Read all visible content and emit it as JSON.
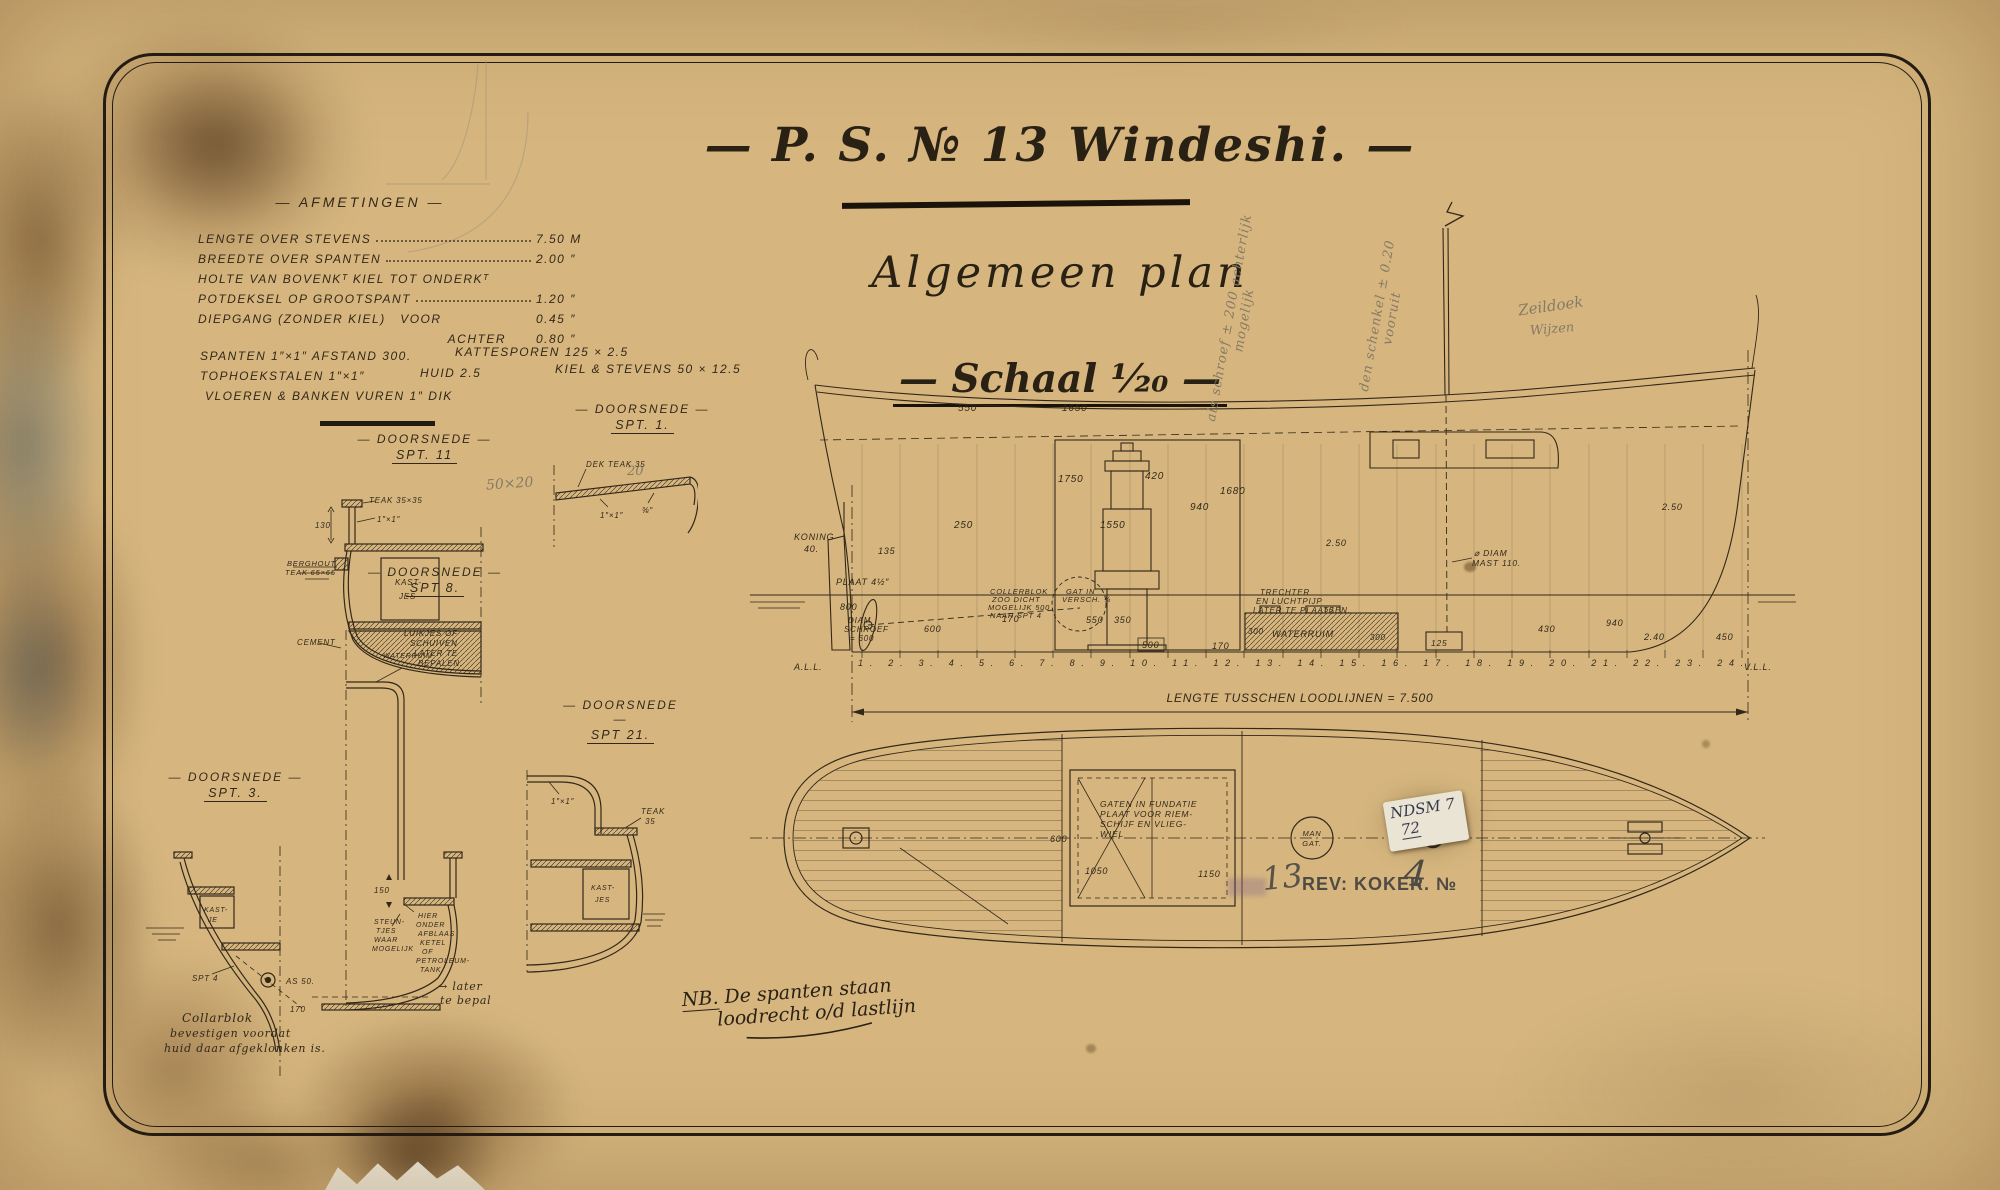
{
  "colors": {
    "paper": "#d6b67e",
    "ink": "#32281a",
    "pencil": "#857a67",
    "stamp": "#4e4a44"
  },
  "title": {
    "main": "— P. S. № 13 Windeshi. —",
    "subtitle": "Algemeen plan",
    "scale": "— Schaal ¹⁄₂₀ —"
  },
  "afmetingen": {
    "heading": "— AFMETINGEN —",
    "rows": [
      {
        "label": "LENGTE OVER STEVENS",
        "value": "7.50 M"
      },
      {
        "label": "BREEDTE OVER SPANTEN",
        "value": "2.00 ″"
      },
      {
        "label": "HOLTE VAN BOVENKᵀ KIEL TOT ONDERKᵀ",
        "value": ""
      },
      {
        "label": "POTDEKSEL OP GROOTSPANT",
        "value": "1.20 ″"
      },
      {
        "label": "DIEPGANG (ZONDER KIEL)   VOOR",
        "value": "0.45 ″"
      },
      {
        "label": "ACHTER",
        "value": "0.80 ″"
      }
    ]
  },
  "specs": {
    "s1a": "SPANTEN 1″×1″ AFSTAND 300.",
    "s1b": "KATTESPOREN 125 × 2.5",
    "s2a": "TOPHOEKSTALEN 1″×1″",
    "s2b": "HUID 2.5",
    "s2c": "KIEL & STEVENS 50 × 12.5",
    "s3": "VLOEREN & BANKEN VUREN 1″ DIK"
  },
  "sections": {
    "spt11": {
      "head": "— DOORSNEDE —",
      "sub": "SPT. 11",
      "pencil": "50×20",
      "teak": "TEAK 35×35",
      "hoek": "1″×1″",
      "d130": "130",
      "berg1": "BERGHOUT",
      "berg2": "TEAK 65×65",
      "kast1": "KAST-",
      "kast2": "JES",
      "cement": "CEMENT",
      "waterruim": "WATERRUIM"
    },
    "spt1": {
      "head": "— DOORSNEDE —",
      "sub": "SPT. 1.",
      "dek": "DEK TEAK 35",
      "pencil": "20",
      "hoek": "1″×1″",
      "dim": "⅜″"
    },
    "spt8": {
      "head": "— DOORSNEDE —",
      "sub": "SPT 8.",
      "lu1": "LUIKJES OF",
      "lu2": "SCHUIVEN",
      "lu3": "LATER TE",
      "lu4": "BEPALEN.",
      "d150": "150",
      "h1": "HIER",
      "h2": "ONDER",
      "h3": "AFBLAAS",
      "h4": "KETEL",
      "h5": "OF",
      "h6": "PETROLEUM-",
      "h7": "TANK",
      "st1": "STEUN-",
      "st2": "TJES",
      "st3": "WAAR",
      "st4": "MOGELIJK",
      "later1": "→ later",
      "later2": "te bepalen."
    },
    "spt3": {
      "head": "— DOORSNEDE —",
      "sub": "SPT. 3.",
      "kast1": "KAST-",
      "kast2": "JE",
      "spt4": "SPT 4",
      "as50": "AS 50.",
      "d170": "170",
      "note1": "Collarblok",
      "note2": "bevestigen voordat",
      "note3": "huid daar afgeklonken is."
    },
    "spt21": {
      "head": "— DOORSNEDE —",
      "sub": "SPT 21.",
      "hoek": "1″×1″",
      "teak": "TEAK",
      "teak2": "35",
      "kast1": "KAST-",
      "kast2": "JES"
    }
  },
  "side_view": {
    "a550": "550",
    "a1650": "1650",
    "a1750": "1750",
    "a1550": "1550",
    "a1680": "1680",
    "a250": "250",
    "a420": "420",
    "a940": "940",
    "koning1": "KONING",
    "koning2": "40.",
    "a135": "135",
    "plaat": "PLAAT 4½″",
    "a800": "800",
    "diam1": "DIAM",
    "diam2": "SCHROEF",
    "diam3": "= 600",
    "a600": "600",
    "coll1": "COLLERBLOK",
    "coll2": "ZOO DICHT",
    "coll3": "MOGELIJK 500",
    "coll4": "NAAR SPT 4",
    "gat1": "GAT IN",
    "gat2": "VERSCH. ¾",
    "b550": "550",
    "b350": "350",
    "b500": "500",
    "b170": "170",
    "c170": "170",
    "tre1": "TRECHTER",
    "tre2": "EN LUCHTPIJP",
    "tre3": "LATER TE PLAATSEN.",
    "wr": "WATERRUIM",
    "w300a": "300",
    "w300b": "300",
    "w50": "50",
    "a125": "125",
    "mast1": "⌀ DIAM",
    "mast2": "MAST 110.",
    "d250a": "2.50",
    "d250b": "2.50",
    "a430": "430",
    "b940": "940",
    "a240": "2.40",
    "a450": "450",
    "vll": "V.L.L.",
    "all": "A.L.L.",
    "frames": "1.   2.   3.   4.   5.   6.   7.   8.   9.   10.   11.   12.   13.   14.   15.   16.   17.   18.   19.   20.   21.   22.   23.   24.",
    "lengte": "LENGTE TUSSCHEN LOODLIJNEN = 7.500"
  },
  "plan_view": {
    "g1": "GATEN IN FUNDATIE",
    "g2": "PLAAT VOOR RIEM-",
    "g3": "SCHIJF EN VLIEG-",
    "g4": "WIEL",
    "p600": "600",
    "p1050": "1050",
    "p1150": "1150",
    "man1": "MAN",
    "man2": "GAT."
  },
  "notes": {
    "nb_label": "NB.",
    "nb1": "  De spanten staan",
    "nb2": "loodrecht o/d lastlijn"
  },
  "pencil_notes": {
    "diag1": "als schroef ± 200 achterlijk mogelijk",
    "diag2": "den schenkel ± 0.20 vooruit",
    "zeildoek": "Zeildoek",
    "wijzen": "Wijzen"
  },
  "stamps": {
    "sticker1": "NDSM 7",
    "sticker2": "72",
    "thirteen": "13",
    "rev": "REV: KOKER. №",
    "rev_no": "4"
  }
}
